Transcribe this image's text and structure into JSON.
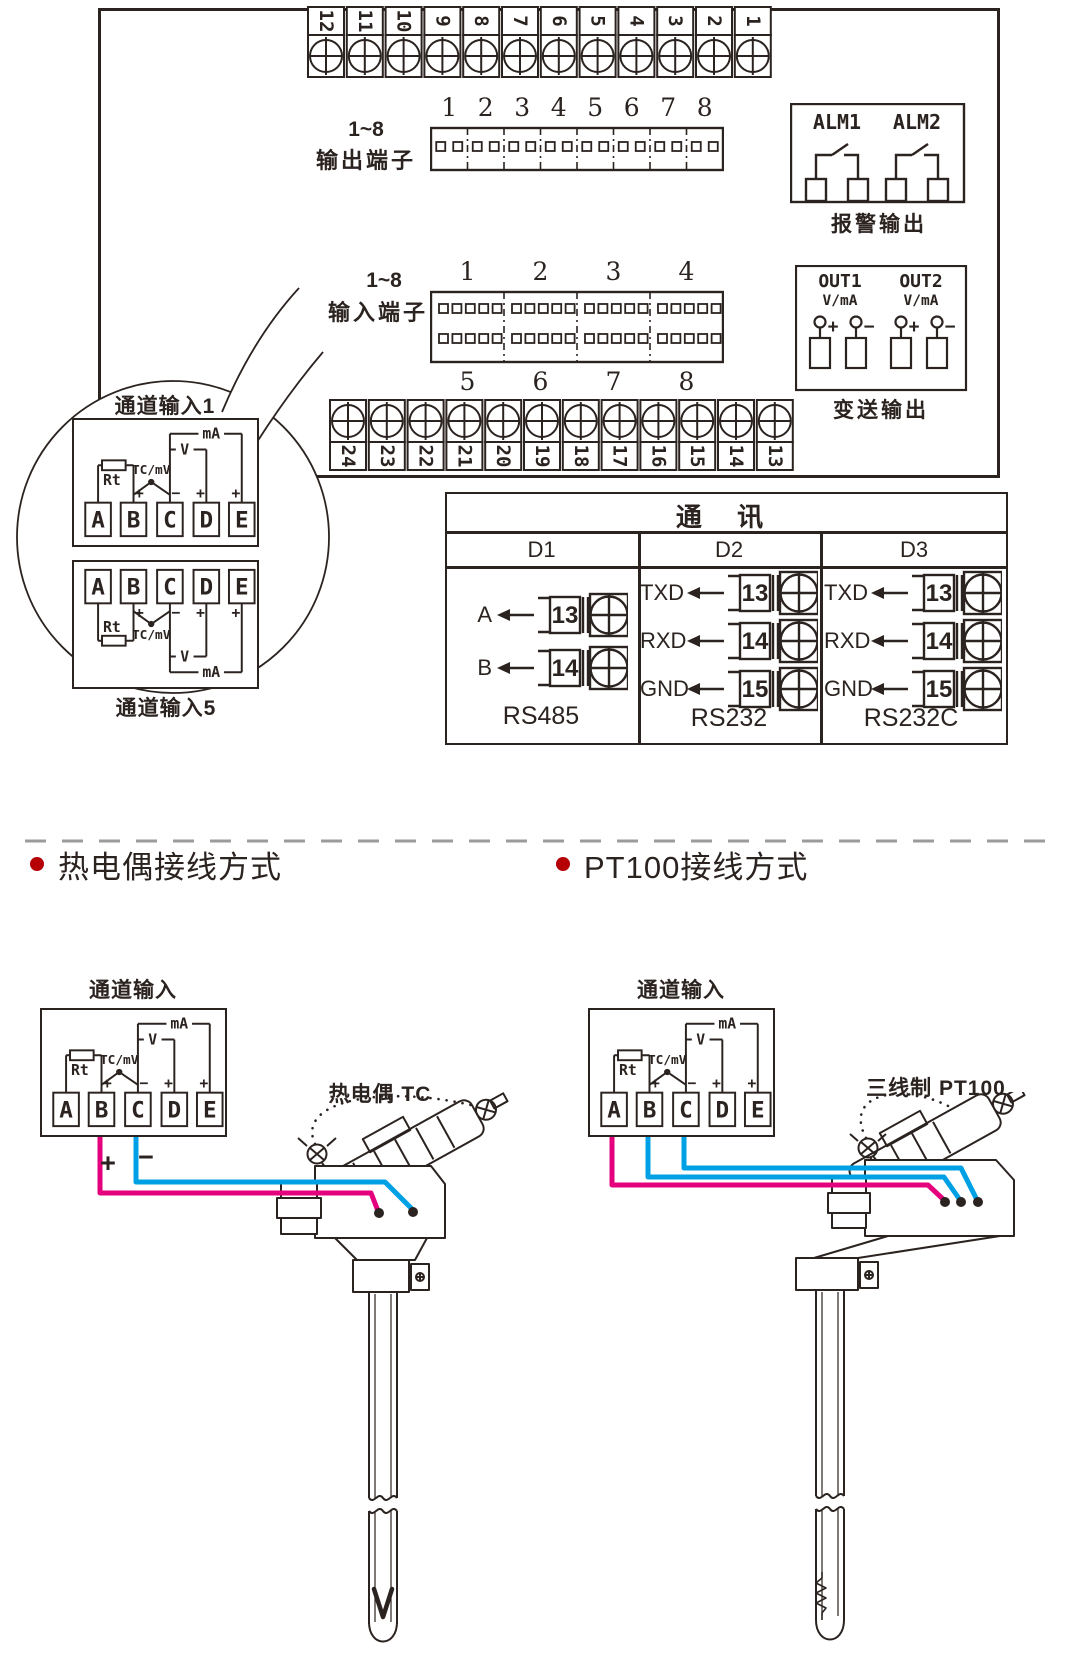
{
  "device": {
    "top_terminals": [
      "12",
      "11",
      "10",
      "9",
      "8",
      "7",
      "6",
      "5",
      "4",
      "3",
      "2",
      "1"
    ],
    "bottom_terminals": [
      "24",
      "23",
      "22",
      "21",
      "20",
      "19",
      "18",
      "17",
      "16",
      "15",
      "14",
      "13"
    ],
    "output_block": {
      "label_line1": "1~8",
      "label_line2": "输出端子",
      "numbers": [
        "1",
        "2",
        "3",
        "4",
        "5",
        "6",
        "7",
        "8"
      ]
    },
    "input_block": {
      "label_line1": "1~8",
      "label_line2": "输入端子",
      "numbers_top": [
        "1",
        "2",
        "3",
        "4"
      ],
      "numbers_bottom": [
        "5",
        "6",
        "7",
        "8"
      ]
    },
    "alarm": {
      "labels": [
        "ALM1",
        "ALM2"
      ],
      "caption": "报警输出"
    },
    "transmit": {
      "labels": [
        "OUT1",
        "OUT2"
      ],
      "sub_label": "V/mA",
      "signs": [
        "+",
        "−",
        "+",
        "−"
      ],
      "caption": "变送输出"
    }
  },
  "balloon": {
    "top_label": "通道输入1",
    "bottom_label": "通道输入5"
  },
  "circuit": {
    "rt": "Rt",
    "tc": "TC/mV",
    "v": "V",
    "ma": "mA",
    "terminals": [
      "A",
      "B",
      "C",
      "D",
      "E"
    ],
    "signs": [
      "+",
      "−",
      "+",
      "+"
    ]
  },
  "comm": {
    "title": "通 讯",
    "columns": [
      {
        "header": "D1",
        "caption": "RS485",
        "rows": [
          {
            "signal": "A",
            "terminal": "13"
          },
          {
            "signal": "B",
            "terminal": "14"
          }
        ]
      },
      {
        "header": "D2",
        "caption": "RS232",
        "rows": [
          {
            "signal": "TXD",
            "terminal": "13"
          },
          {
            "signal": "RXD",
            "terminal": "14"
          },
          {
            "signal": "GND",
            "terminal": "15"
          }
        ]
      },
      {
        "header": "D3",
        "caption": "RS232C",
        "rows": [
          {
            "signal": "TXD",
            "terminal": "13"
          },
          {
            "signal": "RXD",
            "terminal": "14"
          },
          {
            "signal": "GND",
            "terminal": "15"
          }
        ]
      }
    ]
  },
  "sections": {
    "tc": {
      "heading": "热电偶接线方式",
      "channel_label": "通道输入",
      "probe_label": "热电偶 TC",
      "wire_signs": [
        "+",
        "−"
      ]
    },
    "pt": {
      "heading": "PT100接线方式",
      "channel_label": "通道输入",
      "probe_label": "三线制 PT100"
    }
  },
  "colors": {
    "ink": "#2b2320",
    "bullet": "#b50005",
    "wire_plus": "#e5007d",
    "wire_minus": "#00a0e5",
    "divider": "#9b9b9b"
  }
}
